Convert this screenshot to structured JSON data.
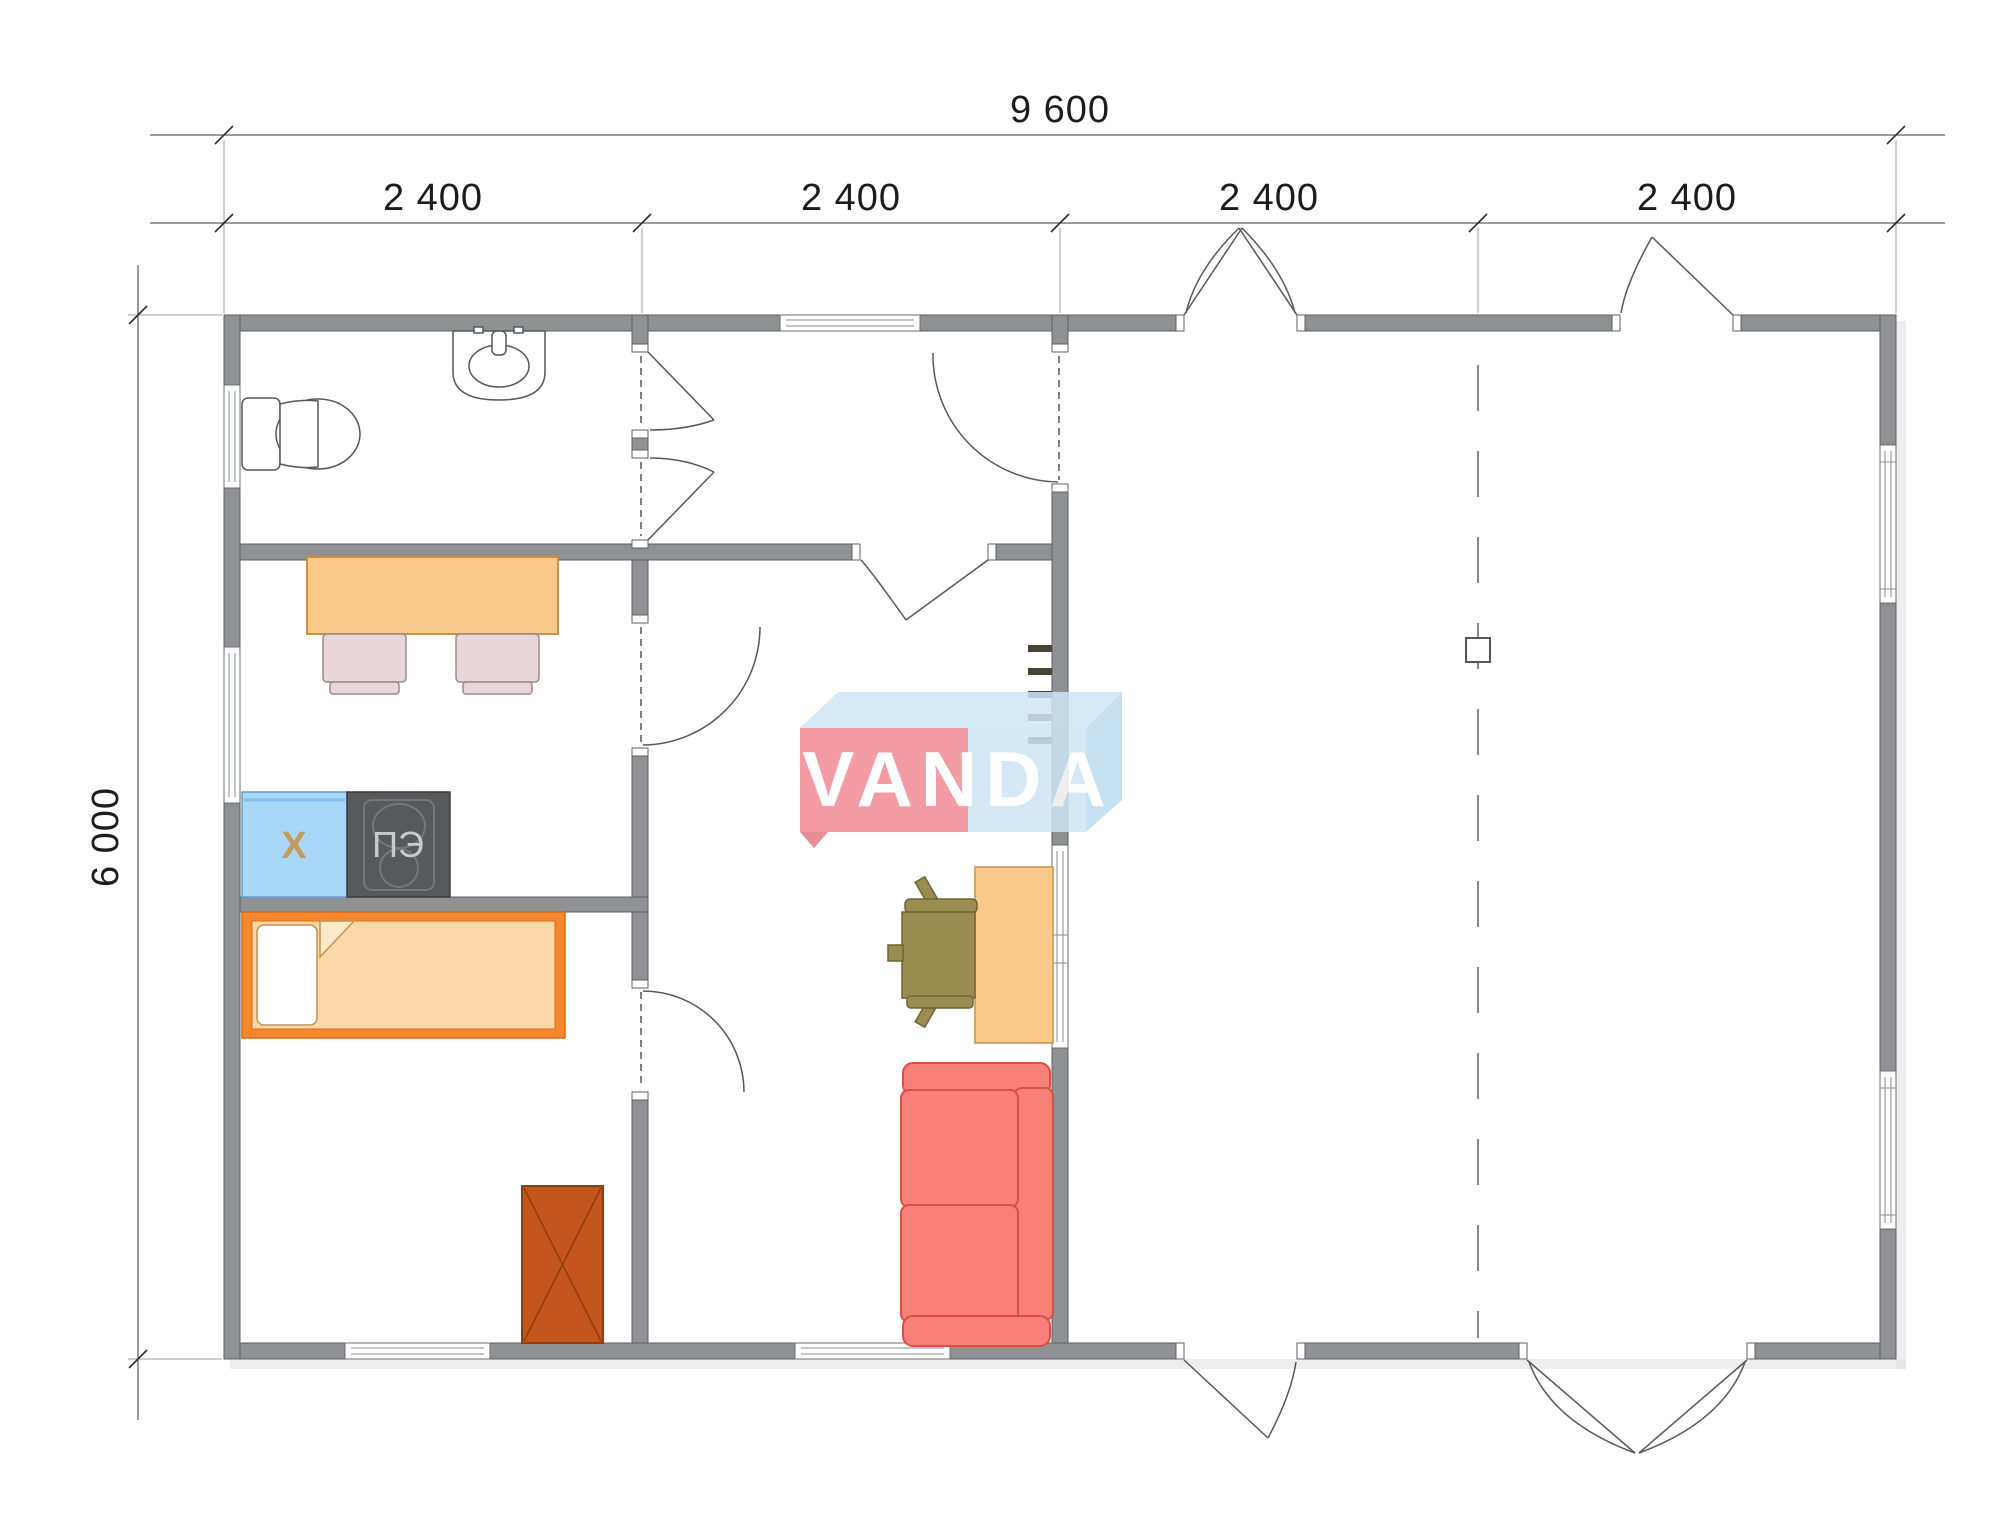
{
  "dimensions": {
    "total_width": "9 600",
    "segments": [
      "2 400",
      "2 400",
      "2 400",
      "2 400"
    ],
    "height": "6 000"
  },
  "labels": {
    "fridge": "X",
    "stove": "ПЭ"
  },
  "watermark": {
    "text": "VANDA"
  },
  "colors": {
    "wall": "#8f9193",
    "table": "#f9c98c",
    "dining_chair": "#e8d6d8",
    "fridge": "#a9d7f8",
    "stove": "#58595b",
    "bed_frame": "#f5872f",
    "bed_fill": "#fbd8a7",
    "cabinet": "#c2561d",
    "sofa": "#f98078",
    "desk": "#f9c98c",
    "office_chair": "#9b8c50",
    "ladder": "#4a4435",
    "logo_pink": "#f28b93",
    "logo_blue": "#cde5f4",
    "logo_blue_top": "#cfe6f5",
    "logo_blue_side": "#bddcf0"
  }
}
